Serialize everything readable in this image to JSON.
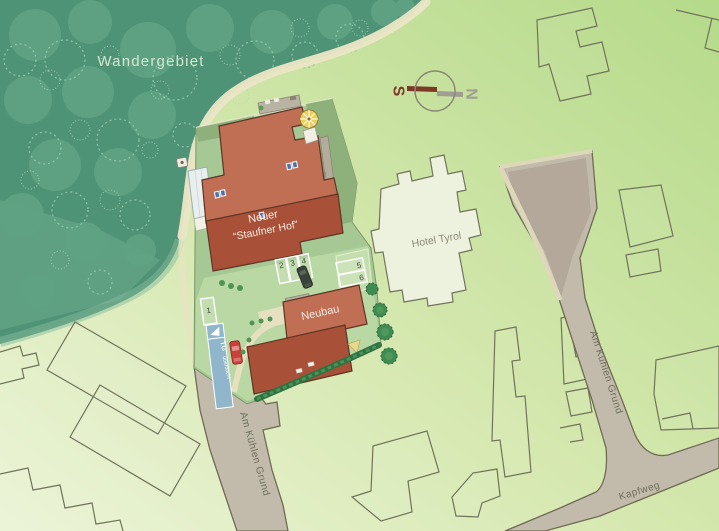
{
  "map": {
    "region_label": "Wandergebiet",
    "compass": {
      "south": "S",
      "north": "N"
    },
    "buildings": {
      "staufner_line1": "Neuer",
      "staufner_line2": "“Staufner Hof”",
      "neubau_label": "Neubau",
      "hotel_label": "Hotel Tyrol"
    },
    "streets": {
      "left_label": "Am Kühlen Grund",
      "right_label": "Am Kühlen Grund",
      "bottom_label": "Kapfweg"
    },
    "parking": {
      "spot_1": "1",
      "spot_2": "2",
      "spot_3": "3",
      "spot_4": "4",
      "spot_5": "5",
      "spot_6": "6",
      "ramp_line1": "TG",
      "ramp_line2": "überdacht"
    },
    "colors": {
      "forest_green": "#4f9377",
      "map_green_light": "#d6e8b0",
      "roof_light": "#c06e54",
      "roof_dark": "#a85138",
      "street_gray": "#c2bbac",
      "parking_lot_gray": "#b1a698",
      "ramp_blue": "#8fb6ca",
      "path_beige": "#ebe6c6",
      "compass_south_red": "#7c3a26",
      "compass_north_gray": "#a19d92"
    }
  }
}
